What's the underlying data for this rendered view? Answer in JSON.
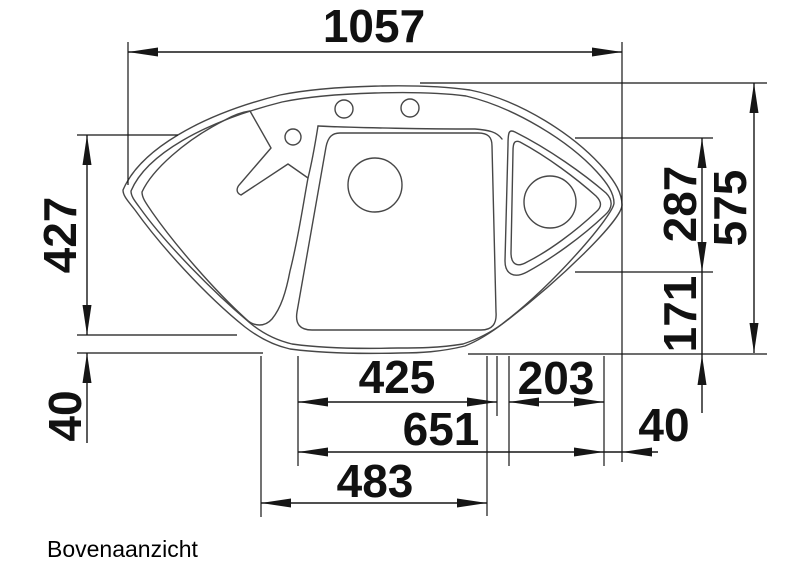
{
  "drawing": {
    "caption": "Bovenaanzicht",
    "view": "top-view technical drawing of corner sink",
    "colors": {
      "background": "#ffffff",
      "sink_outline": "#474747",
      "dimension": "#161616"
    },
    "dims": {
      "overall_width": "1057",
      "left_height": "427",
      "left_bottom_offset": "40",
      "corner_bowl_height": "287",
      "overall_depth": "575",
      "right_lower_height": "171",
      "main_bowl_width": "425",
      "corner_section_width": "203",
      "combined_width": "651",
      "right_offset": "40",
      "drainer_width": "483"
    }
  }
}
